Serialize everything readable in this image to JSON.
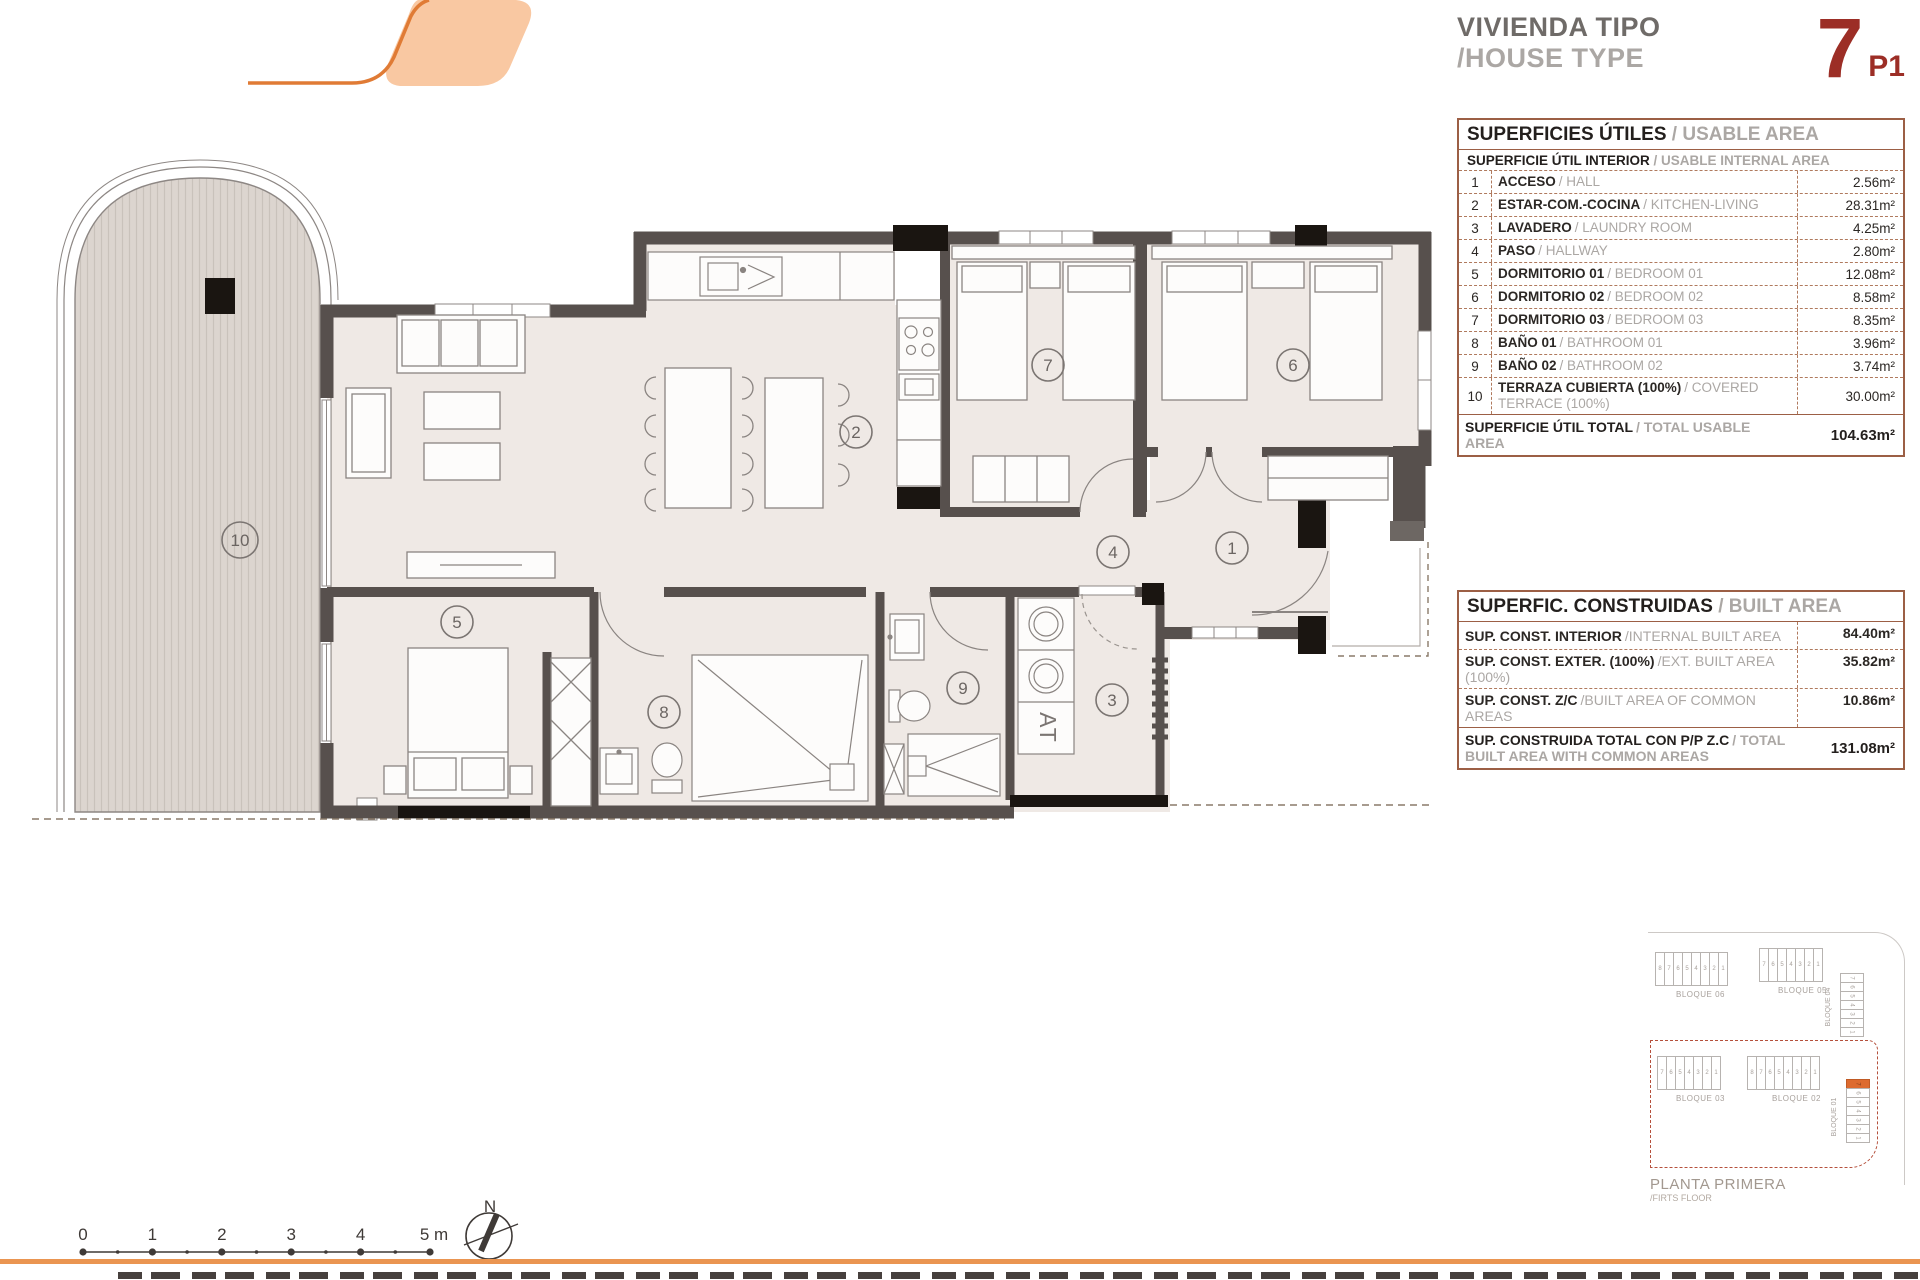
{
  "title": {
    "es": "VIVIENDA TIPO",
    "en": "/HOUSE TYPE",
    "number": "7",
    "floor": "P1"
  },
  "usable_area": {
    "header_es": "SUPERFICIES ÚTILES",
    "header_en": " / USABLE AREA",
    "subheader_es": "SUPERFICIE ÚTIL INTERIOR",
    "subheader_en": " / USABLE INTERNAL AREA",
    "rows": [
      {
        "num": "1",
        "es": "ACCESO",
        "en": "/ HALL",
        "value": "2.56m²"
      },
      {
        "num": "2",
        "es": "ESTAR-COM.-COCINA",
        "en": "/ KITCHEN-LIVING",
        "value": "28.31m²"
      },
      {
        "num": "3",
        "es": "LAVADERO",
        "en": "/ LAUNDRY ROOM",
        "value": "4.25m²"
      },
      {
        "num": "4",
        "es": "PASO",
        "en": "/ HALLWAY",
        "value": "2.80m²"
      },
      {
        "num": "5",
        "es": "DORMITORIO 01",
        "en": "/ BEDROOM 01",
        "value": "12.08m²"
      },
      {
        "num": "6",
        "es": "DORMITORIO 02",
        "en": "/ BEDROOM 02",
        "value": "8.58m²"
      },
      {
        "num": "7",
        "es": "DORMITORIO 03",
        "en": "/ BEDROOM 03",
        "value": "8.35m²"
      },
      {
        "num": "8",
        "es": "BAÑO 01",
        "en": "/ BATHROOM 01",
        "value": "3.96m²"
      },
      {
        "num": "9",
        "es": "BAÑO 02",
        "en": "/ BATHROOM 02",
        "value": "3.74m²"
      },
      {
        "num": "10",
        "es": "TERRAZA CUBIERTA (100%)",
        "en": "/ COVERED TERRACE (100%)",
        "value": "30.00m²"
      }
    ],
    "total_es": "SUPERFICIE ÚTIL TOTAL",
    "total_en": "/ TOTAL USABLE AREA",
    "total_value": "104.63m²"
  },
  "built_area": {
    "header_es": "SUPERFIC. CONSTRUIDAS",
    "header_en": " / BUILT AREA",
    "rows": [
      {
        "es": "SUP. CONST. INTERIOR",
        "en": "/INTERNAL BUILT AREA",
        "value": "84.40m²"
      },
      {
        "es": "SUP. CONST. EXTER. (100%)",
        "en": "/EXT. BUILT AREA (100%)",
        "value": "35.82m²"
      },
      {
        "es": "SUP. CONST. Z/C",
        "en": "/BUILT AREA OF COMMON AREAS",
        "value": "10.86m²"
      }
    ],
    "total_es": "SUP. CONSTRUIDA TOTAL CON P/P Z.C",
    "total_en": "/ TOTAL BUILT AREA WITH COMMON AREAS",
    "total_value": "131.08m²"
  },
  "plan": {
    "rooms": [
      "1",
      "2",
      "3",
      "4",
      "5",
      "6",
      "7",
      "8",
      "9",
      "10"
    ],
    "at_label": "AT"
  },
  "scalebar": {
    "labels": [
      "0",
      "1",
      "2",
      "3",
      "4",
      "5 m"
    ]
  },
  "north_label": "N",
  "keyplan": {
    "blocks": [
      {
        "label": "BLOQUE 06",
        "units": [
          "8",
          "7",
          "6",
          "5",
          "4",
          "3",
          "2",
          "1"
        ]
      },
      {
        "label": "BLOQUE 05",
        "units": [
          "7",
          "6",
          "5",
          "4",
          "3",
          "2",
          "1"
        ]
      },
      {
        "label": "BLOQUE 04",
        "units": [
          "7",
          "6",
          "5",
          "4",
          "3",
          "2",
          "1"
        ]
      },
      {
        "label": "BLOQUE 03",
        "units": [
          "7",
          "6",
          "5",
          "4",
          "3",
          "2",
          "1"
        ]
      },
      {
        "label": "BLOQUE 02",
        "units": [
          "8",
          "7",
          "6",
          "5",
          "4",
          "3",
          "2",
          "1"
        ]
      },
      {
        "label": "BLOQUE 01",
        "units": [
          "7",
          "6",
          "5",
          "4",
          "3",
          "2",
          "1"
        ]
      }
    ],
    "highlighted_unit": "7",
    "floor_es": "PLANTA PRIMERA",
    "floor_en": "/FIRTS FLOOR"
  }
}
